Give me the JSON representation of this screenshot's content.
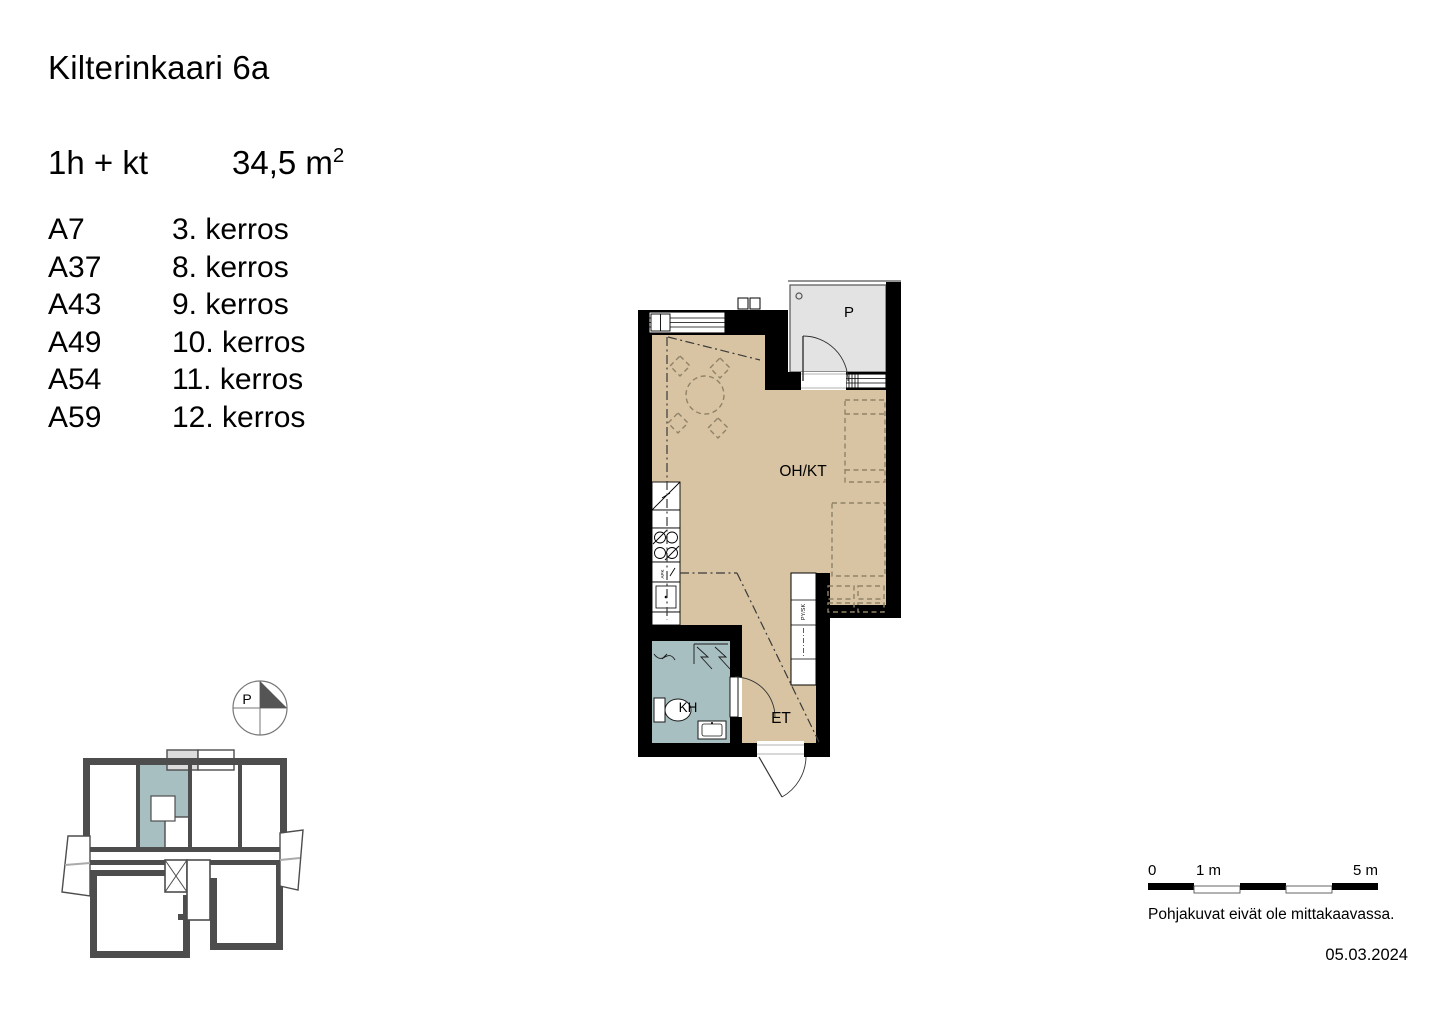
{
  "header": {
    "title": "Kilterinkaari 6a"
  },
  "spec": {
    "type": "1h + kt",
    "area": "34,5 m",
    "area_exponent": "2"
  },
  "apartments": {
    "rows": [
      {
        "code": "A7",
        "floor": "3. kerros"
      },
      {
        "code": "A37",
        "floor": "8. kerros"
      },
      {
        "code": "A43",
        "floor": "9. kerros"
      },
      {
        "code": "A49",
        "floor": "10. kerros"
      },
      {
        "code": "A54",
        "floor": "11. kerros"
      },
      {
        "code": "A59",
        "floor": "12. kerros"
      }
    ]
  },
  "plan": {
    "labels": {
      "living": "OH/KT",
      "entry": "ET",
      "bathroom": "KH",
      "balcony": "P",
      "closet": "PY/SK",
      "dishwasher": "APK"
    },
    "colors": {
      "floor": "#d8c4a2",
      "bathroom": "#a7bfc1",
      "balcony": "#e3e3e3",
      "wall": "#000000",
      "furniture": "#8f8268",
      "keyplan_wall": "#4d4d4d",
      "keyplan_balcony": "#dcdcdc",
      "keyplan_highlight": "#a7bfc1"
    }
  },
  "compass": {
    "label": "P"
  },
  "scalebar": {
    "zero": "0",
    "one": "1 m",
    "five": "5 m"
  },
  "footer": {
    "disclaimer": "Pohjakuvat eivät ole mittakaavassa.",
    "date": "05.03.2024"
  }
}
